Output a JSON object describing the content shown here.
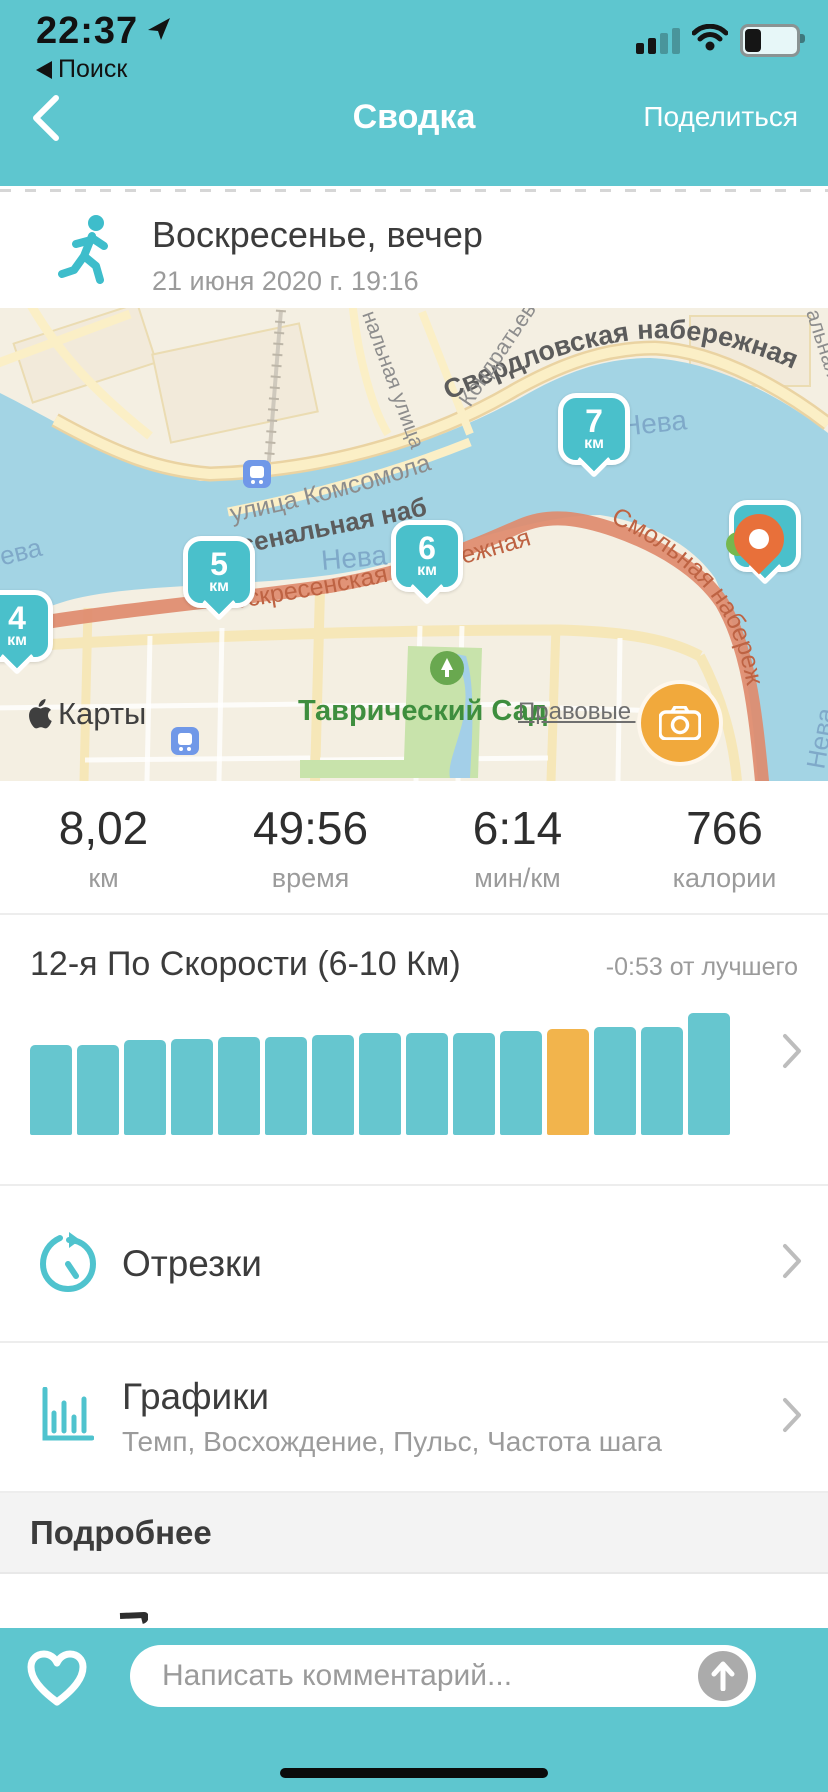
{
  "status_bar": {
    "time": "22:37",
    "back_app": "Поиск"
  },
  "nav": {
    "title": "Сводка",
    "share": "Поделиться"
  },
  "activity": {
    "title": "Воскресенье, вечер",
    "datetime": "21 июня 2020 г. 19:16"
  },
  "map": {
    "attribution": "Карты",
    "legal": "Правовые доку...",
    "labels": {
      "sverdlovskaya": "Свердловская набережная",
      "arsenalnaya": "Арсенальная набережная",
      "voskresenskaya": "Воскресенская набережная",
      "smolnaya": "Смольная набережная",
      "komsomola": "улица Комсомола",
      "kondratyev": "Кондратьев",
      "nalnaya": "нальная улица",
      "alnaya": "альная",
      "neva_top": "Нева",
      "neva_mid": "Нева",
      "neva_left": "Нева",
      "neva_right": "Нева",
      "park": "Таврический Сад"
    },
    "km_markers": [
      {
        "value": "4",
        "unit": "км"
      },
      {
        "value": "5",
        "unit": "км"
      },
      {
        "value": "6",
        "unit": "км"
      },
      {
        "value": "7",
        "unit": "км"
      },
      {
        "value": "8",
        "unit": "км"
      }
    ]
  },
  "stats": {
    "items": [
      {
        "value": "8,02",
        "label": "км"
      },
      {
        "value": "49:56",
        "label": "время"
      },
      {
        "value": "6:14",
        "label": "мин/км"
      },
      {
        "value": "766",
        "label": "калории"
      }
    ]
  },
  "record": {
    "title": "12-я По Скорости (6-10 Км)",
    "delta": "-0:53 от лучшего"
  },
  "chart_data": {
    "type": "bar",
    "title": "12-я По Скорости (6-10 Км)",
    "subtitle": "-0:53 от лучшего",
    "values": [
      90,
      90,
      95,
      96,
      98,
      98,
      100,
      102,
      102,
      102,
      104,
      106,
      108,
      108,
      122
    ],
    "values_note": "relative bar heights in px; no numeric axis shown in UI",
    "highlight_index": 11,
    "bar_color": "#66C6CF",
    "highlight_color": "#F2B44C",
    "xlabel": "",
    "ylabel": "",
    "grid": false,
    "legend": false
  },
  "sections": {
    "splits": {
      "label": "Отрезки"
    },
    "charts": {
      "label": "Графики",
      "subtitle": "Темп, Восхождение, Пульс, Частота шага"
    },
    "more": {
      "label": "Подробнее"
    }
  },
  "comment_bar": {
    "placeholder": "Написать комментарий..."
  },
  "colors": {
    "accent_teal": "#5EC6CF",
    "marker_teal": "#4AC0CB",
    "route_orange": "#DE8B6E",
    "camera_orange": "#F1A93C",
    "bar_teal": "#66C6CF",
    "bar_highlight": "#F2B44C",
    "water": "#A3D4E4",
    "land": "#F4EFE2"
  }
}
